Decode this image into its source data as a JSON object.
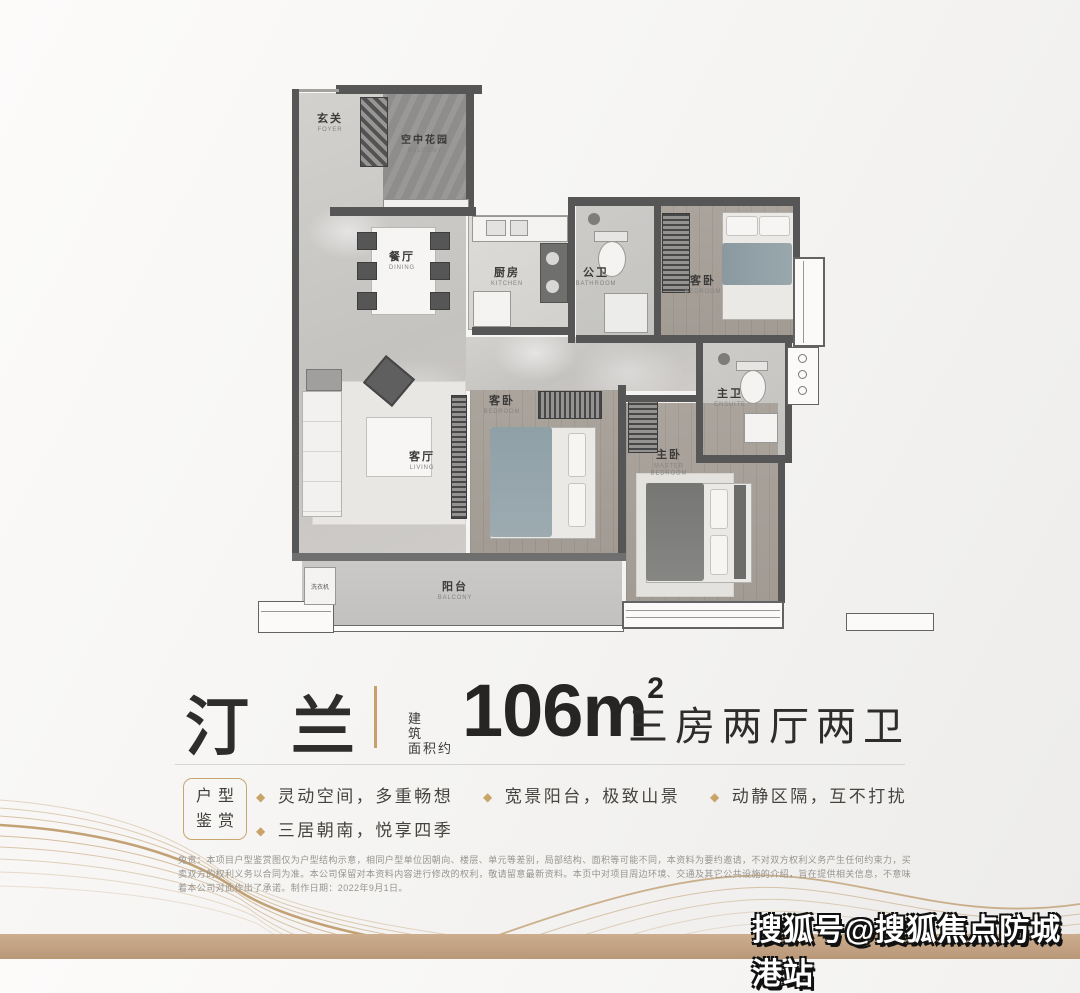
{
  "title": {
    "name": "汀兰",
    "area_label_line1": "建筑",
    "area_label_line2": "面积约",
    "area_value": "106m",
    "area_sup": "2",
    "spec": "三房两厅两卫"
  },
  "features": {
    "badge_line1": "户型",
    "badge_line2": "鉴赏",
    "bullet": "◆",
    "items": [
      "灵动空间，多重畅想",
      "宽景阳台，极致山景",
      "动静区隔，互不打扰",
      "三居朝南，悦享四季"
    ]
  },
  "plan": {
    "rooms": {
      "foyer": {
        "label": "玄关",
        "en": "FOYER"
      },
      "garden": {
        "label": "空中花园",
        "en": "BALCONY"
      },
      "dining": {
        "label": "餐厅",
        "en": "DINING"
      },
      "kitchen": {
        "label": "厨房",
        "en": "KITCHEN"
      },
      "guest_bath": {
        "label": "公卫",
        "en": "BATHROOM"
      },
      "bedroom_top": {
        "label": "客卧",
        "en": "BEDROOM"
      },
      "ensuite": {
        "label": "主卫",
        "en": "ENSUITE"
      },
      "living": {
        "label": "客厅",
        "en": "LIVING"
      },
      "bedroom_mid": {
        "label": "客卧",
        "en": "BEDROOM"
      },
      "master": {
        "label": "主卧",
        "en": "MASTER BEDROOM"
      },
      "balcony": {
        "label": "阳台",
        "en": "BALCONY"
      },
      "washer": {
        "label": "洗衣机"
      }
    }
  },
  "disclaimer": "免责：本项目户型鉴赏图仅为户型结构示意，相同户型单位因朝向、楼层、单元等差别，局部结构、面积等可能不同，本资料为要约邀请，不对双方权利义务产生任何约束力，买卖双方的权利义务以合同为准。本公司保留对本资料内容进行修改的权利，敬请留意最新资料。本页中对项目周边环境、交通及其它公共设施的介绍，旨在提供相关信息，不意味着本公司对此作出了承诺。制作日期：2022年9月1日。",
  "watermark": "搜狐号@搜狐焦点防城港站",
  "colors": {
    "accent": "#c49a67",
    "bottom_bar": "#c2a284",
    "wall": "#565656"
  }
}
